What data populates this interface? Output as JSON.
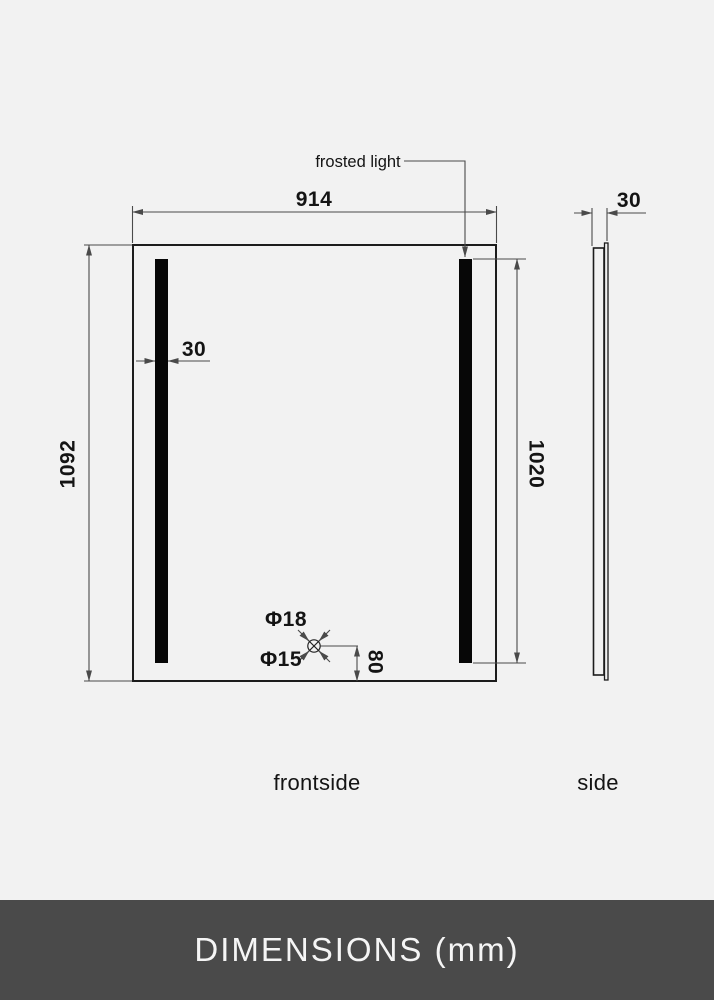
{
  "footer": {
    "label": "DIMENSIONS (mm)"
  },
  "front_view": {
    "label": "frontside",
    "light_annotation": "frosted light",
    "width_mm": "914",
    "height_mm": "1092",
    "light_height_mm": "1020",
    "light_strip_width_mm": "30",
    "hole_outer_diameter": "Φ18",
    "hole_inner_diameter": "Φ15",
    "hole_offset_mm": "80"
  },
  "side_view": {
    "label": "side",
    "depth_mm": "30"
  },
  "colors": {
    "background": "#f2f2f2",
    "line": "#4a4a4a",
    "outline": "#1c1c1c",
    "bar": "#070707",
    "text": "#141414",
    "footer_bg": "#4a4a4a",
    "footer_text": "#f5f5f5"
  }
}
